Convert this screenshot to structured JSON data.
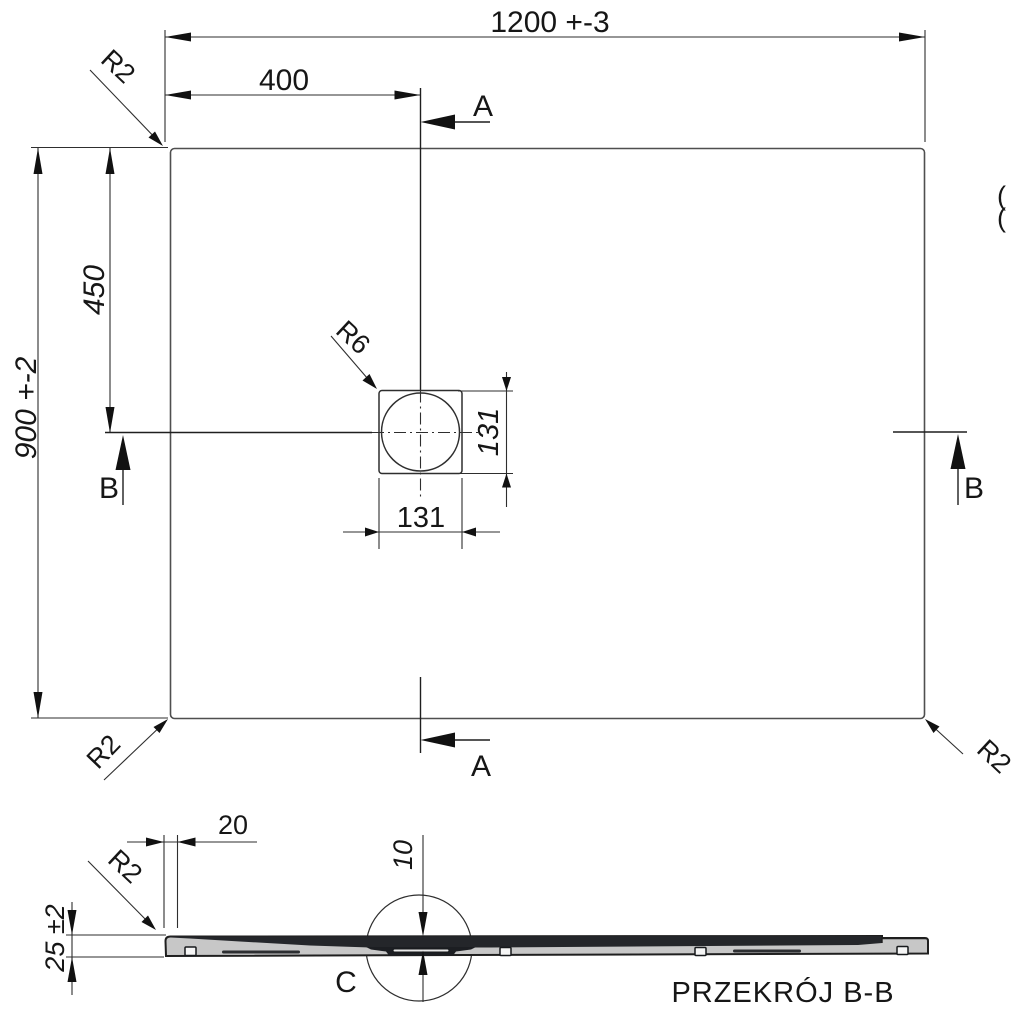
{
  "plan_view": {
    "dim_width": "1200 +-3",
    "dim_height": "900 +-2",
    "dim_drain_offset_x": "400",
    "dim_drain_offset_y": "450",
    "dim_drain_width": "131",
    "dim_drain_height": "131",
    "radius_top_left": "R2",
    "radius_bottom_left": "R2",
    "radius_bottom_right": "R2",
    "radius_drain": "R6",
    "section_a_top": "A",
    "section_a_bottom": "A",
    "section_b_left": "B",
    "section_b_right": "B",
    "edge_artifact_1": "(",
    "edge_artifact_2": "("
  },
  "section_view": {
    "title": "PRZEKRÓJ B-B",
    "dim_rim_width": "20",
    "dim_drain_depth": "10",
    "dim_thickness": "25 ±2",
    "radius_edge": "R2",
    "detail_label": "C"
  },
  "colors": {
    "line": "#2e2e2e",
    "object_line": "#4f4f4f",
    "text": "#161616",
    "tray_fill": "#c7c7c7",
    "tray_surface": "#24262a",
    "recess": "#1c1e22",
    "background": "#ffffff"
  }
}
